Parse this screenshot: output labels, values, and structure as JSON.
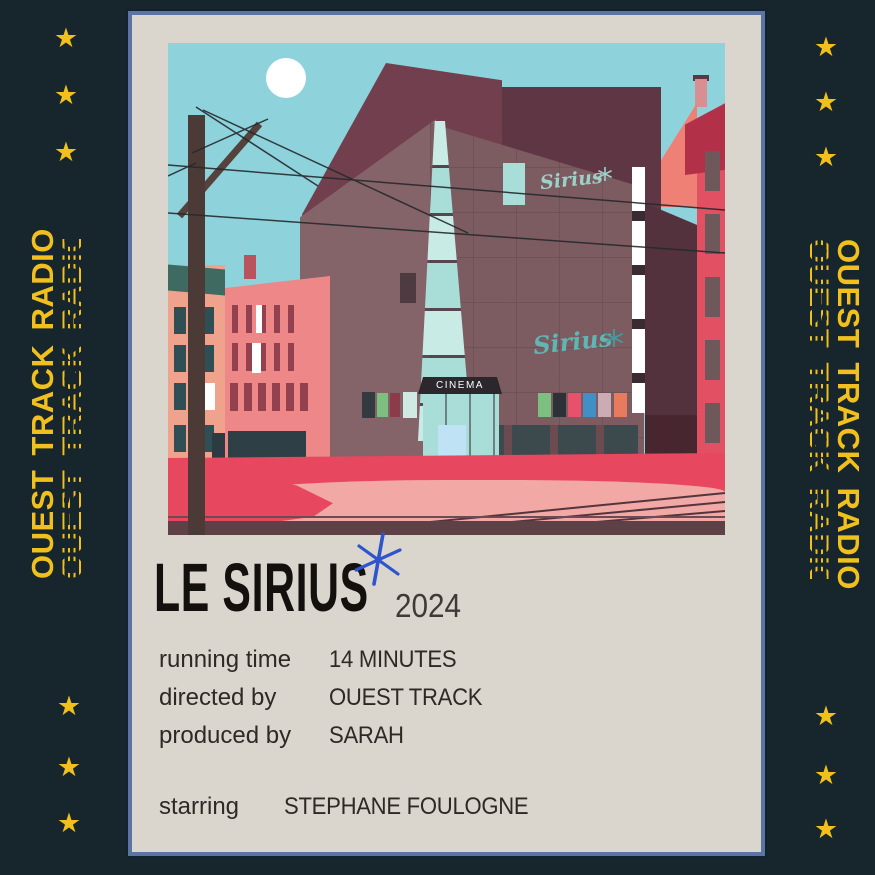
{
  "frame": {
    "side_text": "OUEST TRACK RADIO",
    "star_glyph": "★"
  },
  "poster": {
    "title": "LE SIRIUS",
    "year": "2024",
    "credits": [
      {
        "label": "running time",
        "value": "14 MINUTES"
      },
      {
        "label": "directed by",
        "value": "OUEST TRACK"
      },
      {
        "label": "produced by",
        "value": "SARAH"
      },
      {
        "label": "starring",
        "value": "STEPHANE FOULOGNE"
      }
    ]
  },
  "illustration": {
    "cinema_sign": "CINEMA",
    "marquee_script_upper": "Sirius",
    "marquee_script_lower": "Sirius"
  },
  "palette": {
    "bg": "#17262d",
    "yellow": "#f2c01c",
    "card": "#dad6ce",
    "cardBorder": "#5b74a4",
    "sky": "#8ed2dc",
    "blueSparkle": "#2f55cc",
    "tealGlass": "#a9ddd7",
    "tealGlassLight": "#c9ebe6",
    "tealScript": "#7cc4bd",
    "mauveFront": "#7c5b61",
    "mauveLight": "#846369",
    "maroonTop": "#713f4e",
    "maroonDark": "#5f3744",
    "salmonBld": "#efa28c",
    "pinkBld": "#ee8787",
    "redBld": "#e25064",
    "crimson": "#b23048",
    "salmonRoof": "#ef8076",
    "windowTeal": "#2f4f55",
    "windowMaroon": "#93414e",
    "groundRed": "#e8485f",
    "sidewalkPink": "#f2a8a4",
    "curb": "#5e4047",
    "pole": "#4b3a36",
    "winGray": "#6f585c",
    "doorBlue": "#bfe3f5",
    "posterGreen": "#7cbf80",
    "posterBlack": "#2c3237",
    "posterRed": "#e8516b",
    "posterBlue": "#418fc4",
    "posterPink": "#ccabb5",
    "posterOrange": "#e87a5e"
  }
}
